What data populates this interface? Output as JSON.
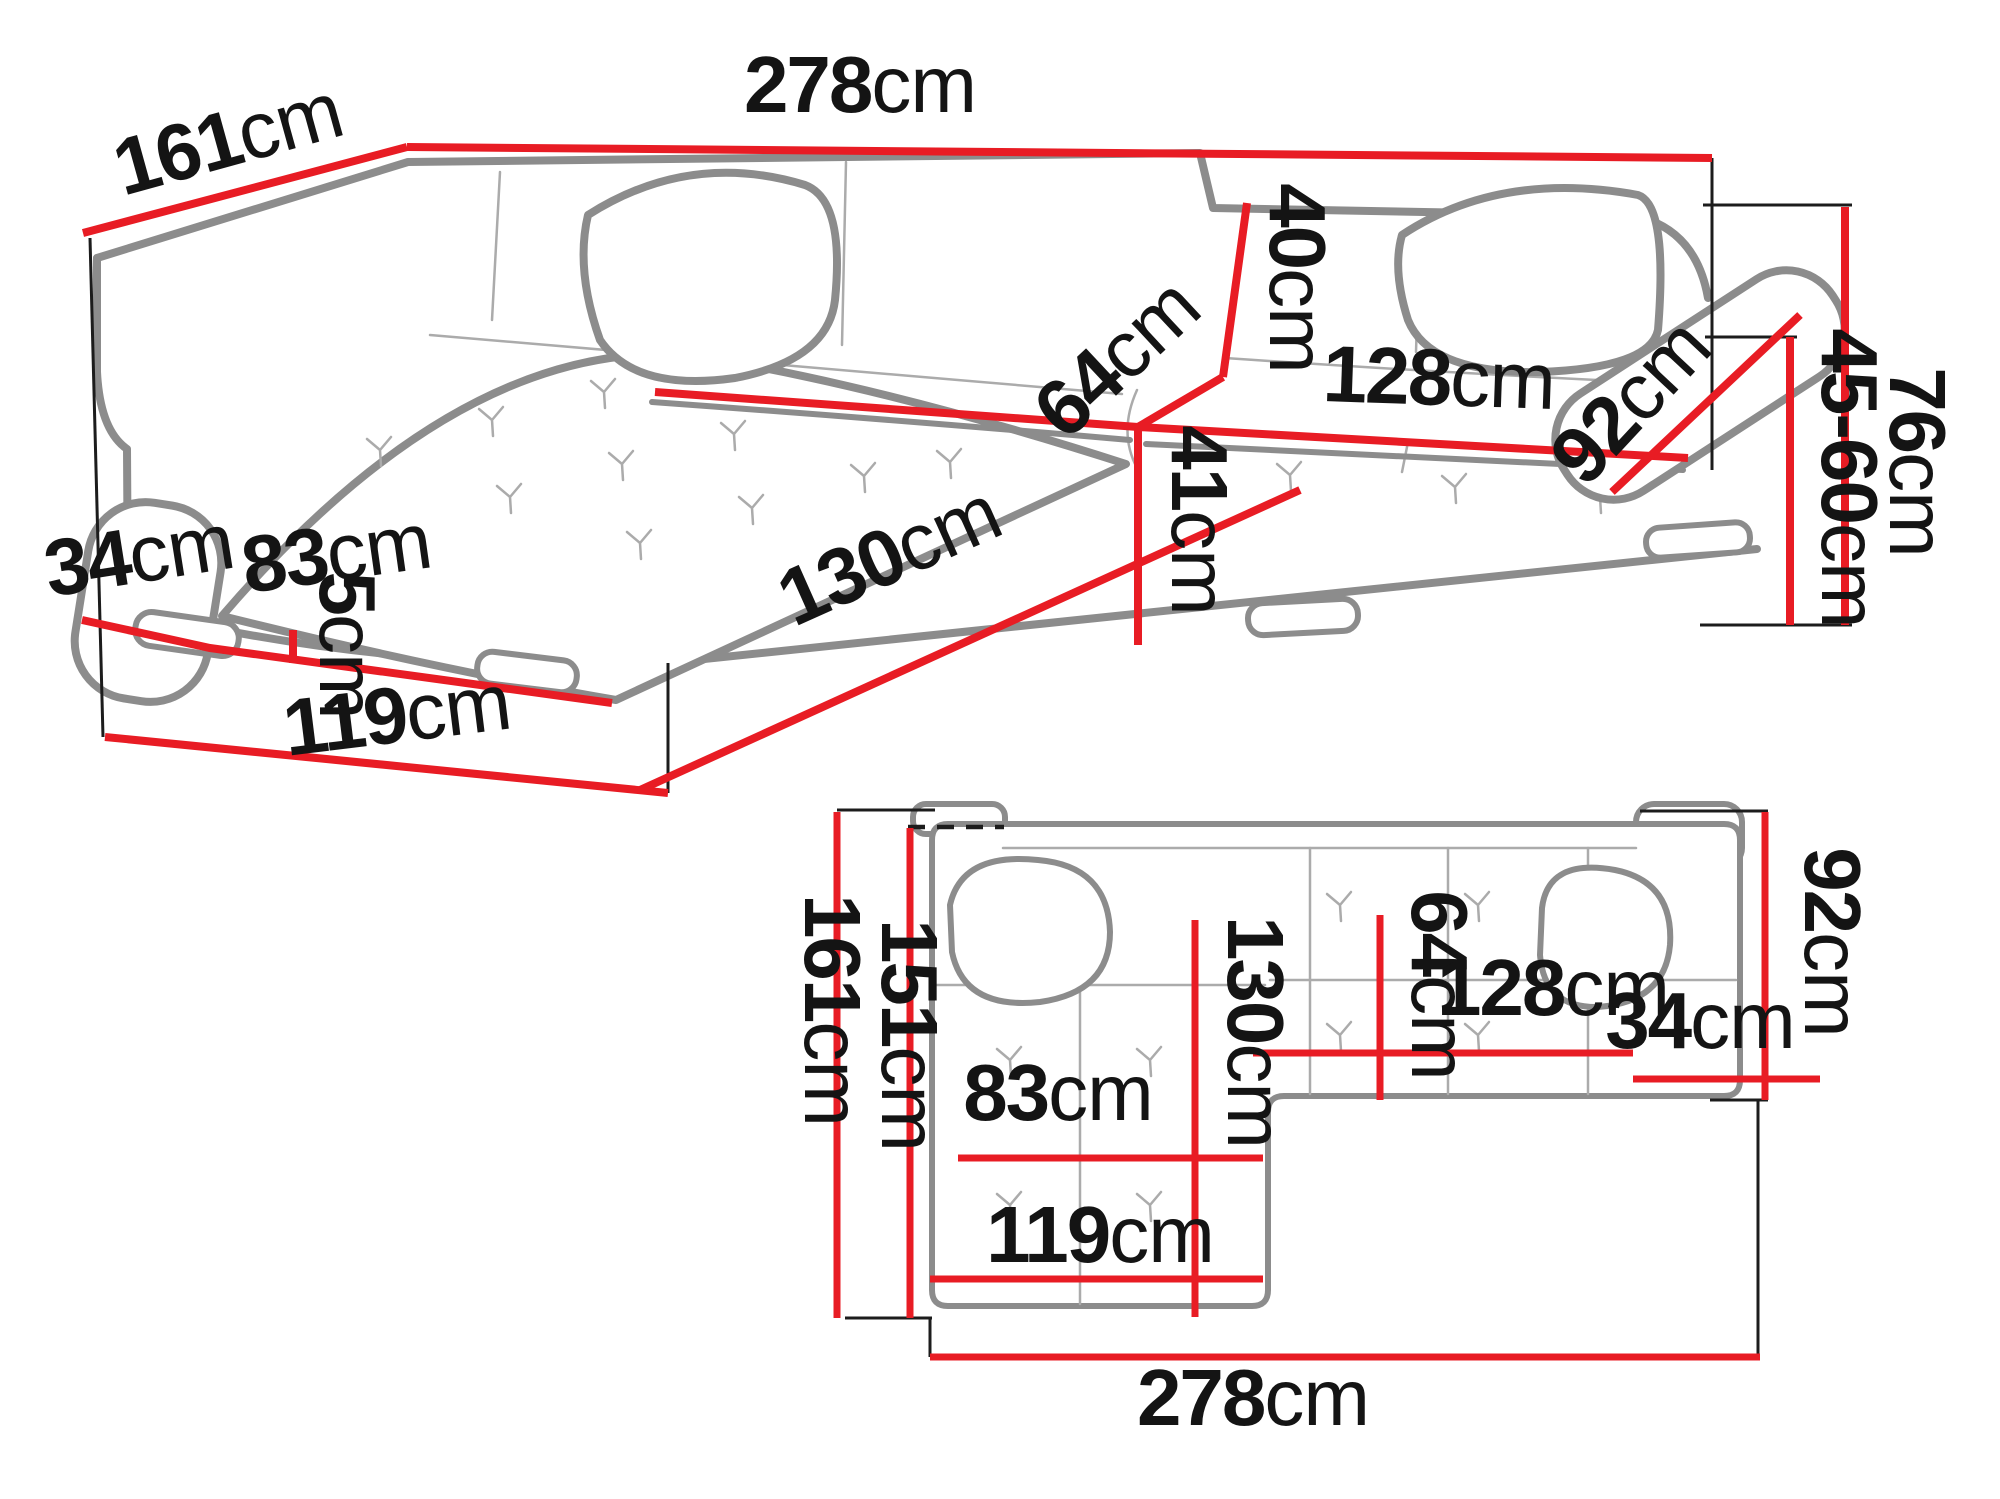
{
  "figure": {
    "type": "furniture-dimension-diagram",
    "subject": "corner-sofa-with-chaise",
    "unit": "cm",
    "colors": {
      "dimension_line": "#e81c24",
      "sofa_outline": "#8c8c8c",
      "extension_line": "#1c1c1c",
      "text": "#141414",
      "background": "#ffffff"
    }
  },
  "views": {
    "perspective": {
      "name": "perspective-view",
      "dims": [
        {
          "id": "back-left-depth",
          "value": "161",
          "unit": "cm"
        },
        {
          "id": "total-width",
          "value": "278",
          "unit": "cm"
        },
        {
          "id": "backrest-height",
          "value": "40",
          "unit": "cm"
        },
        {
          "id": "seat-depth",
          "value": "64",
          "unit": "cm"
        },
        {
          "id": "right-seat-width",
          "value": "128",
          "unit": "cm"
        },
        {
          "id": "right-armrest-length",
          "value": "92",
          "unit": "cm"
        },
        {
          "id": "total-height",
          "value": "76",
          "unit": "cm"
        },
        {
          "id": "armrest-height-range",
          "value": "45-60",
          "unit": "cm"
        },
        {
          "id": "left-armrest-width",
          "value": "34",
          "unit": "cm"
        },
        {
          "id": "chaise-seat-width",
          "value": "83",
          "unit": "cm"
        },
        {
          "id": "chaise-length",
          "value": "130",
          "unit": "cm"
        },
        {
          "id": "seat-height",
          "value": "41",
          "unit": "cm"
        },
        {
          "id": "leg-height",
          "value": "5",
          "unit": "cm"
        },
        {
          "id": "chaise-side-depth",
          "value": "119",
          "unit": "cm"
        }
      ]
    },
    "plan": {
      "name": "top-view",
      "dims": [
        {
          "id": "total-depth",
          "value": "161",
          "unit": "cm"
        },
        {
          "id": "depth-without-back",
          "value": "151",
          "unit": "cm"
        },
        {
          "id": "chaise-length",
          "value": "130",
          "unit": "cm"
        },
        {
          "id": "seat-depth",
          "value": "64",
          "unit": "cm"
        },
        {
          "id": "right-section-depth",
          "value": "92",
          "unit": "cm"
        },
        {
          "id": "right-seat-width",
          "value": "128",
          "unit": "cm"
        },
        {
          "id": "right-armrest-width",
          "value": "34",
          "unit": "cm"
        },
        {
          "id": "chaise-seat-width",
          "value": "83",
          "unit": "cm"
        },
        {
          "id": "chaise-outer-width",
          "value": "119",
          "unit": "cm"
        },
        {
          "id": "total-width",
          "value": "278",
          "unit": "cm"
        }
      ]
    }
  }
}
